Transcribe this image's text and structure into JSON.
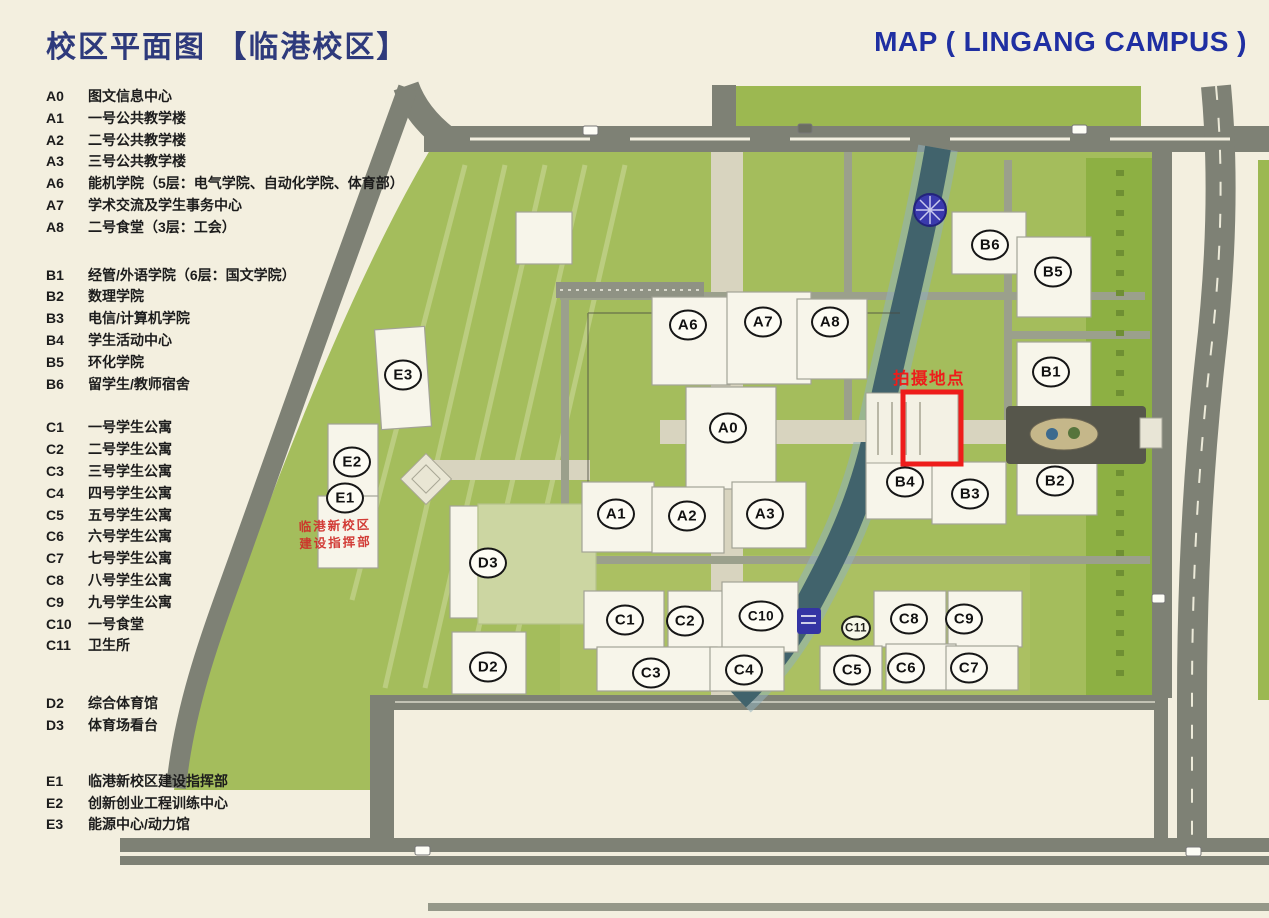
{
  "header": {
    "title_zh": "校区平面图 【临港校区】",
    "title_en": "MAP ( LINGANG CAMPUS )"
  },
  "legend": {
    "groups": [
      {
        "name": "A",
        "items": [
          {
            "code": "A0",
            "label": "图文信息中心"
          },
          {
            "code": "A1",
            "label": "一号公共教学楼"
          },
          {
            "code": "A2",
            "label": "二号公共教学楼"
          },
          {
            "code": "A3",
            "label": "三号公共教学楼"
          },
          {
            "code": "A6",
            "label": "能机学院（5层：电气学院、自动化学院、体育部）"
          },
          {
            "code": "A7",
            "label": "学术交流及学生事务中心"
          },
          {
            "code": "A8",
            "label": "二号食堂（3层：工会）"
          }
        ]
      },
      {
        "name": "B",
        "items": [
          {
            "code": "B1",
            "label": "经管/外语学院（6层：国文学院）"
          },
          {
            "code": "B2",
            "label": "数理学院"
          },
          {
            "code": "B3",
            "label": "电信/计算机学院"
          },
          {
            "code": "B4",
            "label": "学生活动中心"
          },
          {
            "code": "B5",
            "label": "环化学院"
          },
          {
            "code": "B6",
            "label": "留学生/教师宿舍"
          }
        ]
      },
      {
        "name": "C",
        "items": [
          {
            "code": "C1",
            "label": "一号学生公寓"
          },
          {
            "code": "C2",
            "label": "二号学生公寓"
          },
          {
            "code": "C3",
            "label": "三号学生公寓"
          },
          {
            "code": "C4",
            "label": "四号学生公寓"
          },
          {
            "code": "C5",
            "label": "五号学生公寓"
          },
          {
            "code": "C6",
            "label": "六号学生公寓"
          },
          {
            "code": "C7",
            "label": "七号学生公寓"
          },
          {
            "code": "C8",
            "label": "八号学生公寓"
          },
          {
            "code": "C9",
            "label": "九号学生公寓"
          },
          {
            "code": "C10",
            "label": "一号食堂"
          },
          {
            "code": "C11",
            "label": "卫生所"
          }
        ]
      },
      {
        "name": "D",
        "items": [
          {
            "code": "D2",
            "label": "综合体育馆"
          },
          {
            "code": "D3",
            "label": "体育场看台"
          }
        ]
      },
      {
        "name": "E",
        "items": [
          {
            "code": "E1",
            "label": "临港新校区建设指挥部"
          },
          {
            "code": "E2",
            "label": "创新创业工程训练中心"
          },
          {
            "code": "E3",
            "label": "能源中心/动力馆"
          }
        ]
      }
    ]
  },
  "map": {
    "photo_annotation": {
      "label": "拍摄地点"
    },
    "construction_sign": {
      "line1": "临港新校区",
      "line2": "建设指挥部"
    },
    "markers": [
      {
        "code": "A0",
        "x": 728,
        "y": 428
      },
      {
        "code": "A1",
        "x": 616,
        "y": 514
      },
      {
        "code": "A2",
        "x": 687,
        "y": 516
      },
      {
        "code": "A3",
        "x": 765,
        "y": 514
      },
      {
        "code": "A6",
        "x": 688,
        "y": 325
      },
      {
        "code": "A7",
        "x": 763,
        "y": 322
      },
      {
        "code": "A8",
        "x": 830,
        "y": 322
      },
      {
        "code": "B1",
        "x": 1051,
        "y": 372
      },
      {
        "code": "B2",
        "x": 1055,
        "y": 481
      },
      {
        "code": "B3",
        "x": 970,
        "y": 494
      },
      {
        "code": "B4",
        "x": 905,
        "y": 482
      },
      {
        "code": "B5",
        "x": 1053,
        "y": 272
      },
      {
        "code": "B6",
        "x": 990,
        "y": 245
      },
      {
        "code": "C1",
        "x": 625,
        "y": 620
      },
      {
        "code": "C2",
        "x": 685,
        "y": 621
      },
      {
        "code": "C3",
        "x": 651,
        "y": 673
      },
      {
        "code": "C4",
        "x": 744,
        "y": 670
      },
      {
        "code": "C5",
        "x": 852,
        "y": 670
      },
      {
        "code": "C6",
        "x": 906,
        "y": 668
      },
      {
        "code": "C7",
        "x": 969,
        "y": 668
      },
      {
        "code": "C8",
        "x": 909,
        "y": 619
      },
      {
        "code": "C9",
        "x": 964,
        "y": 619
      },
      {
        "code": "C10",
        "x": 761,
        "y": 616
      },
      {
        "code": "C11",
        "x": 856,
        "y": 628,
        "small": true
      },
      {
        "code": "D2",
        "x": 488,
        "y": 667
      },
      {
        "code": "D3",
        "x": 488,
        "y": 563
      },
      {
        "code": "E1",
        "x": 345,
        "y": 498
      },
      {
        "code": "E2",
        "x": 352,
        "y": 462
      },
      {
        "code": "E3",
        "x": 403,
        "y": 375
      }
    ],
    "colors": {
      "paper": "#f3efdf",
      "field_green": "#a4bd5c",
      "dark_green": "#8db043",
      "road_gray": "#7e8175",
      "river_teal": "#41636c",
      "building_white": "#f7f5ea",
      "accent_red": "#ee1d1b",
      "title_navy_zh": "#2e3a7c",
      "title_navy_en": "#1f2fa2",
      "river_marker_blue": "#3a3aad"
    }
  }
}
